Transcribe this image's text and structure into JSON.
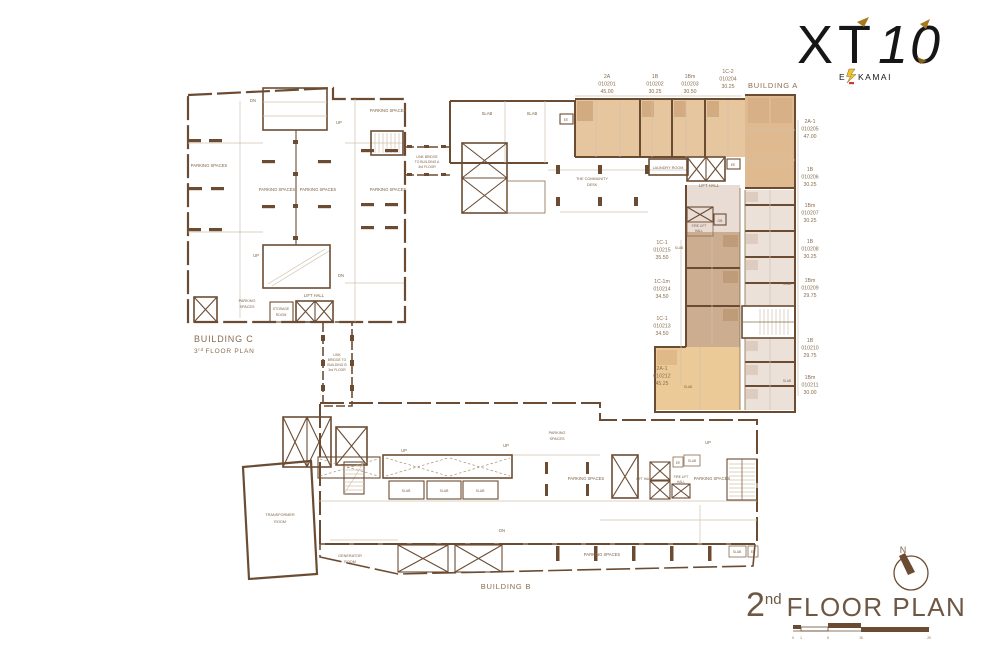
{
  "logo": {
    "brand": "XT",
    "number": "10",
    "ekkamai_e": "E",
    "ekkamai_rest": "KAMAI"
  },
  "plan_title": {
    "number": "2",
    "superscript": "nd",
    "text": "FLOOR PLAN"
  },
  "north_label": "N",
  "scale_labels": [
    "0",
    "1",
    "5",
    "10",
    "20"
  ],
  "buildings": {
    "a": {
      "name": "BUILDING A"
    },
    "b": {
      "name": "BUILDING B"
    },
    "c": {
      "name": "BUILDING C",
      "floor_number": "3",
      "floor_superscript": "rd",
      "floor_text": "FLOOR PLAN"
    }
  },
  "bridge_to_a": {
    "lines": [
      "LINK BRIDGE",
      "TO BUILDING A",
      "3rd FLOOR"
    ]
  },
  "bridge_to_b": {
    "lines": [
      "LINK",
      "BRIDGE TO",
      "BUILDING B",
      "3rd FLOOR"
    ]
  },
  "rooms": {
    "parking": "PARKING SPACES",
    "parking_line1": "PARKING",
    "parking_line2": "SPACES",
    "slab": "SLAB",
    "ee": "EE",
    "gb": "GB",
    "up": "UP",
    "dn": "DN",
    "lift_hall": "LIFT HALL",
    "fire_lift_line1": "FIRE LIFT",
    "fire_lift_line2": "HALL",
    "laundry": "LAUNDRY ROOM",
    "community_line1": "THE COMMUNITY",
    "community_line2": "DESK",
    "storage_line1": "STORAGE",
    "storage_line2": "ROOM",
    "transformer_line1": "TRANSFORMER",
    "transformer_line2": "ROOM",
    "generator_line1": "GENERATOR",
    "generator_line2": "ROOM"
  },
  "units_top": [
    {
      "type": "2A",
      "no": "010201",
      "area": "45.00"
    },
    {
      "type": "1B",
      "no": "010202",
      "area": "30.25"
    },
    {
      "type": "1Bm",
      "no": "010203",
      "area": "30.50"
    },
    {
      "type": "1C-2",
      "no": "010204",
      "area": "30.25"
    }
  ],
  "units_right": [
    {
      "type": "2A-1",
      "no": "010205",
      "area": "47.00"
    },
    {
      "type": "1B",
      "no": "010206",
      "area": "30.25"
    },
    {
      "type": "1Bm",
      "no": "010207",
      "area": "30.25"
    },
    {
      "type": "1B",
      "no": "010208",
      "area": "30.25"
    },
    {
      "type": "1Bm",
      "no": "010209",
      "area": "29.75"
    },
    {
      "type": "1B",
      "no": "010210",
      "area": "29.75"
    },
    {
      "type": "1Bm",
      "no": "010211",
      "area": "30.00"
    }
  ],
  "units_left": [
    {
      "type": "1C-1",
      "no": "010215",
      "area": "35.50"
    },
    {
      "type": "1C-1m",
      "no": "010214",
      "area": "34.50"
    },
    {
      "type": "1C-1",
      "no": "010213",
      "area": "34.50"
    },
    {
      "type": "2A-1",
      "no": "010212",
      "area": "45.25"
    }
  ],
  "colors": {
    "wall": "#6b4c33",
    "unit_tan": "#e6c69e",
    "unit_tan_dark": "#d3ab80",
    "unit_brown": "#cdad8f",
    "unit_orange": "#ecca97",
    "unit_pink": "#ece1d9",
    "text_brown": "#7d6248",
    "gold": "#a8781e",
    "bolt_yellow": "#f2c12e"
  }
}
